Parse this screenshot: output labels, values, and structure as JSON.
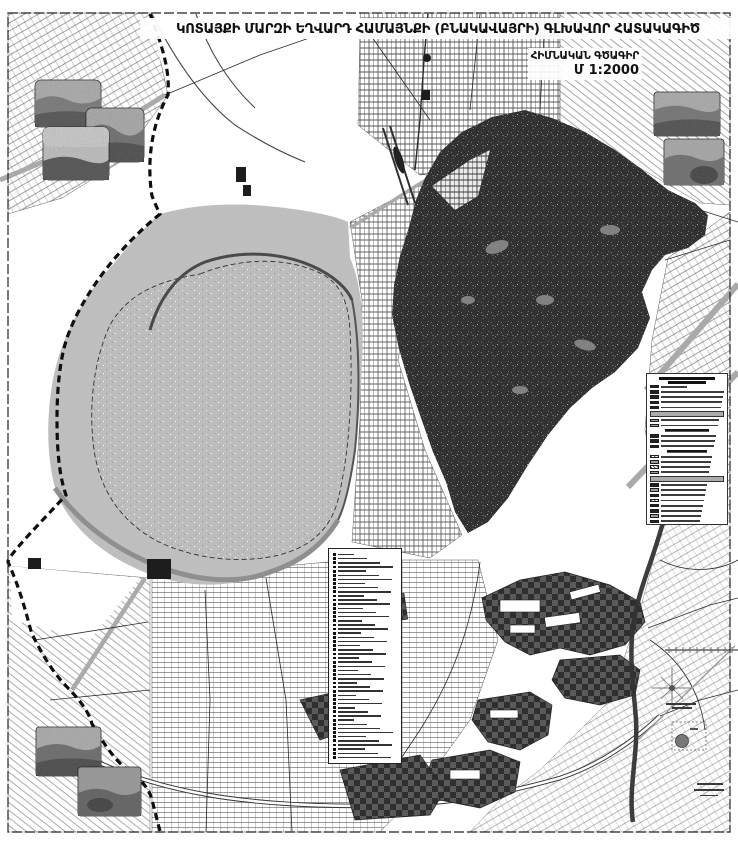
{
  "header": {
    "title": "ԿՈՏԱՅՔԻ ՄԱՐԶԻ ԵՂՎԱՐԴ ՀԱՄԱՅՆՔԻ (ԲՆԱԿԱՎԱՅՐԻ) ԳԼԽԱՎՈՐ ՀԱՏԱԿԱԳԻԾ",
    "drawing_type": "ՀԻՄՆԱԿԱՆ ԳԾԱԳԻՐ",
    "scale": "Մ 1:2000"
  },
  "colors": {
    "paper": "#ffffff",
    "reservoir_fill": "#bcbcbc",
    "buffer_fill": "#c0c0c0",
    "urban_fill": "#2b2b2b",
    "industrial_dark": "#2f2f2f",
    "industrial_light": "#5a5a5a",
    "road_gray": "#aaaaaa",
    "ink": "#1a1a1a"
  },
  "legend_right": {
    "row_types": [
      "dark",
      "dark",
      "dark",
      "dark",
      "dark",
      "band",
      "gray",
      "gray",
      "header",
      "dark",
      "dark",
      "dark",
      "header",
      "hatch",
      "gray",
      "hatch",
      "gray",
      "band",
      "dark",
      "gray",
      "dark",
      "hatch",
      "dark",
      "dark",
      "gray",
      "dark"
    ]
  },
  "legend_center": {
    "row_count": 50
  },
  "photos": {
    "top_left": 3,
    "top_right": 2,
    "bottom_left": 2
  }
}
